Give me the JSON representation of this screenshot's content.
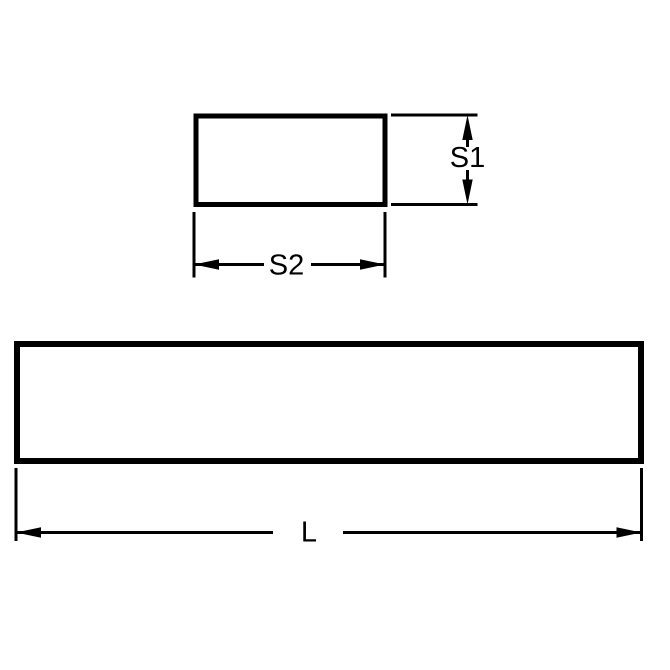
{
  "colors": {
    "line": "#000000",
    "background": "#ffffff"
  },
  "drawing": {
    "labels": {
      "height": "S1",
      "width": "S2",
      "length": "L"
    }
  }
}
